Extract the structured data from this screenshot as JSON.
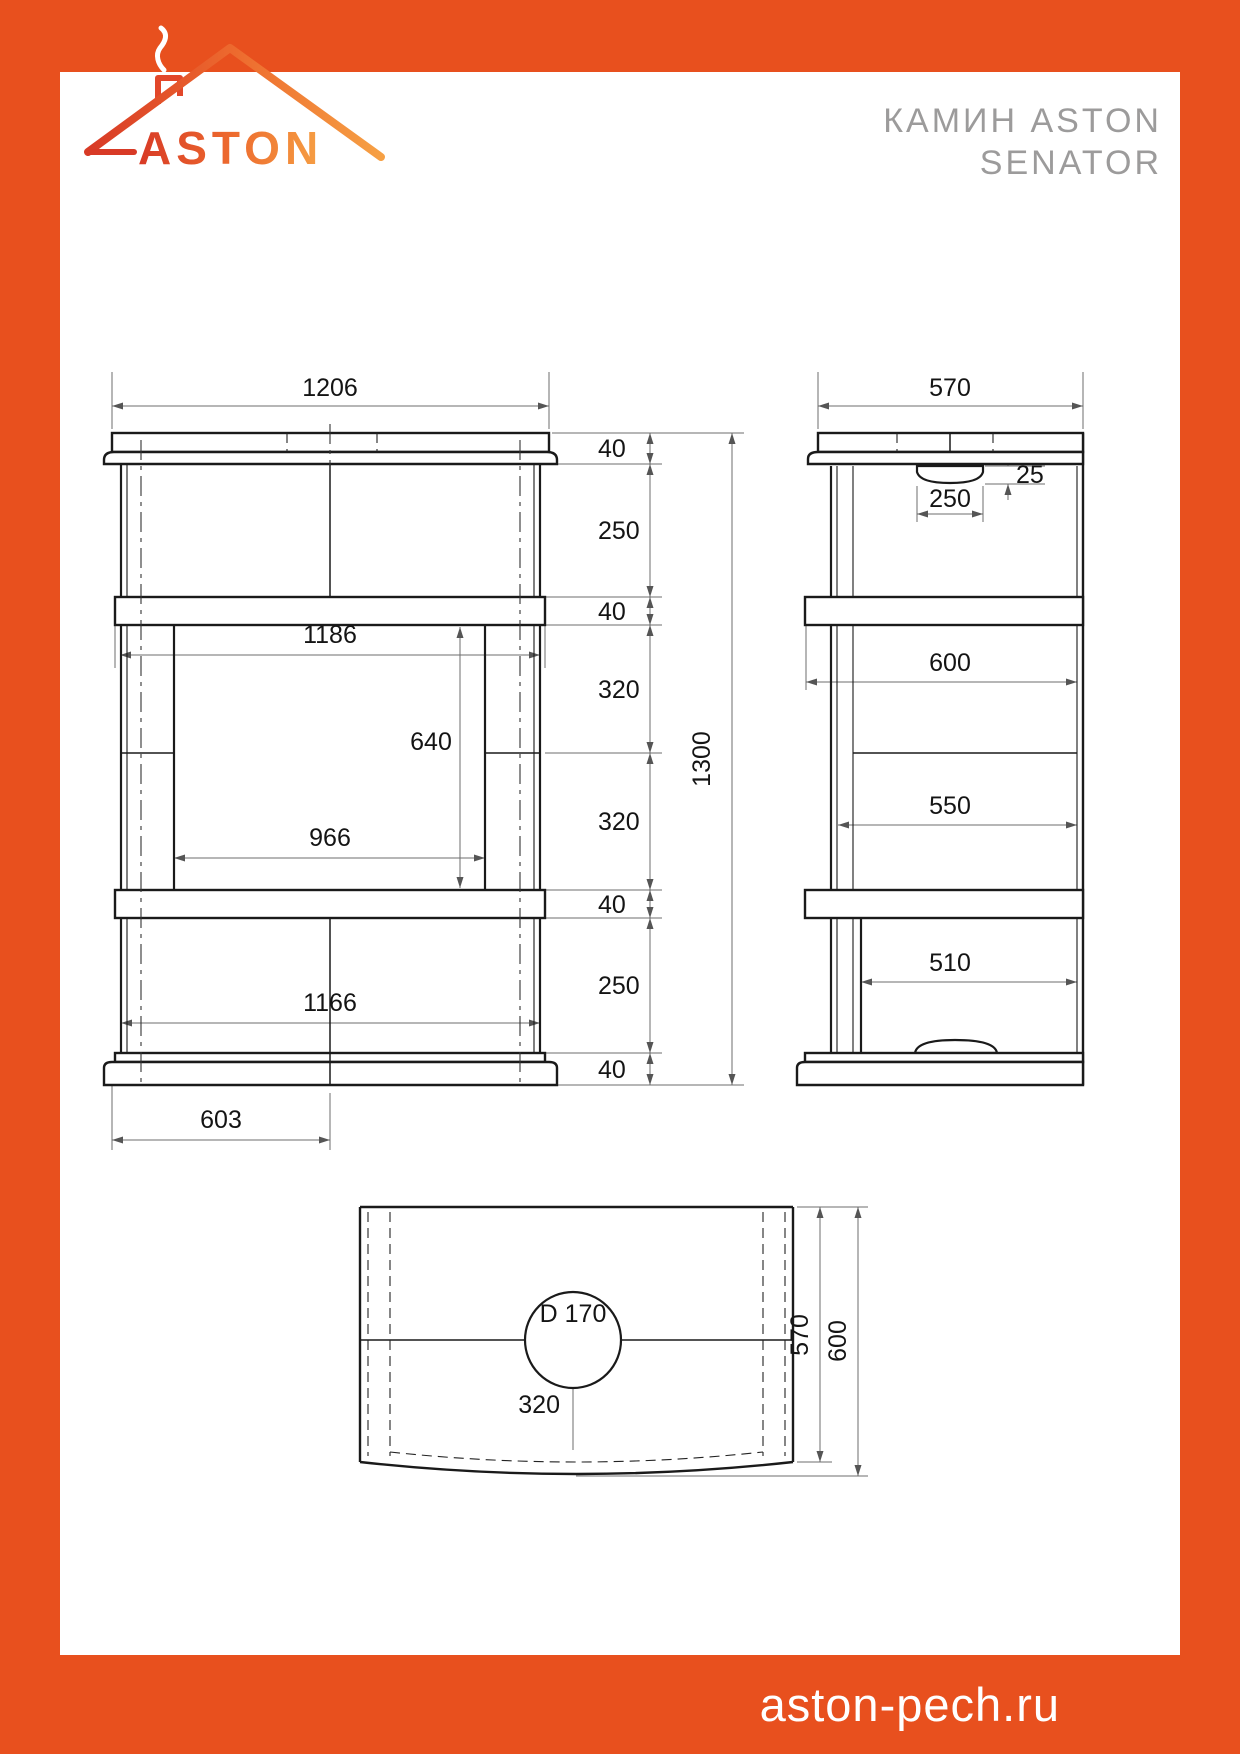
{
  "header": {
    "logo_text": "ASTON",
    "title_line1": "КАМИН ASTON",
    "title_line2": "SENATOR"
  },
  "footer": {
    "website": "aston-pech.ru"
  },
  "colors": {
    "accent": "#E8501E",
    "logo_gradient_start": "#D83A26",
    "logo_gradient_end": "#F6A044",
    "title_gray": "#9C9B9B",
    "line_color": "#1A1A1A",
    "dim_color": "#6E6E6E"
  },
  "front_view": {
    "overall_width": "1206",
    "overall_height": "1300",
    "crown_height": "40",
    "upper_body_height": "250",
    "upper_shelf_height": "40",
    "shelf_width": "1186",
    "firebox_top_course": "320",
    "firebox_opening_height": "640",
    "firebox_bottom_course": "320",
    "firebox_opening_width": "966",
    "lower_shelf_height": "40",
    "lower_body_height": "250",
    "body_width": "1166",
    "plinth_height": "40",
    "half_width": "603"
  },
  "side_view": {
    "top_depth": "570",
    "damper_height": "25",
    "damper_width": "250",
    "shelf_depth": "600",
    "body_depth": "550",
    "lower_depth": "510"
  },
  "top_view": {
    "flue_diameter": "D 170",
    "flue_center_offset": "320",
    "depth": "570",
    "total_depth": "600"
  }
}
